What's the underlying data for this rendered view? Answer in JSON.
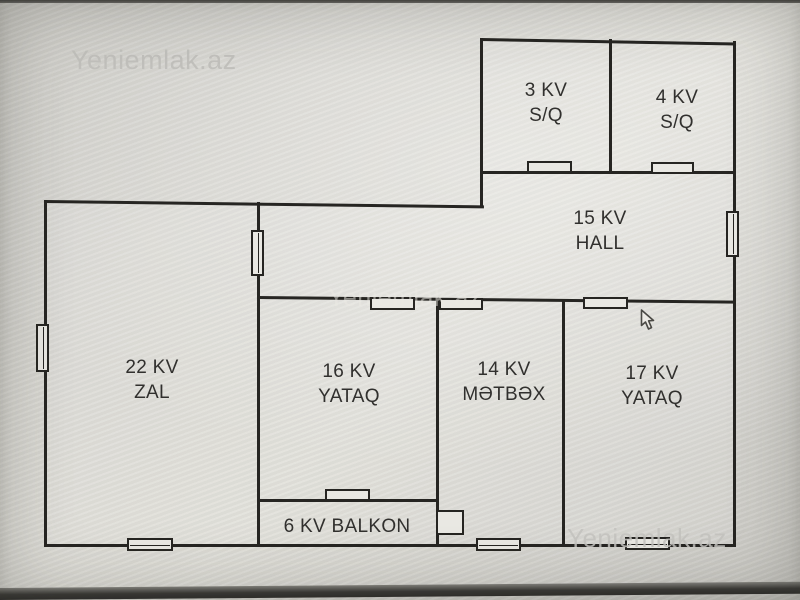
{
  "watermarks": {
    "top": "Yeniemlak.az",
    "middle": "Yeniemlak.az",
    "bottom": "Yeniemlak.az"
  },
  "floorplan": {
    "rooms": [
      {
        "key": "sq3",
        "area": "3 KV",
        "name": "S/Q"
      },
      {
        "key": "sq4",
        "area": "4 KV",
        "name": "S/Q"
      },
      {
        "key": "hall",
        "area": "15 KV",
        "name": "HALL"
      },
      {
        "key": "zal",
        "area": "22 KV",
        "name": "ZAL"
      },
      {
        "key": "yataq16",
        "area": "16 KV",
        "name": "YATAQ"
      },
      {
        "key": "metbex",
        "area": "14 KV",
        "name": "MƏTBƏX"
      },
      {
        "key": "yataq17",
        "area": "17 KV",
        "name": "YATAQ"
      },
      {
        "key": "balkon",
        "label": "6 KV BALKON"
      }
    ]
  },
  "icons": {
    "cursor": "arrow-pointer"
  },
  "colors": {
    "wall": "#262522",
    "label_text": "#31302e",
    "watermark": "#c0bfbb",
    "screen_background": "#d8d7d2",
    "bezel": "#3a3936"
  }
}
